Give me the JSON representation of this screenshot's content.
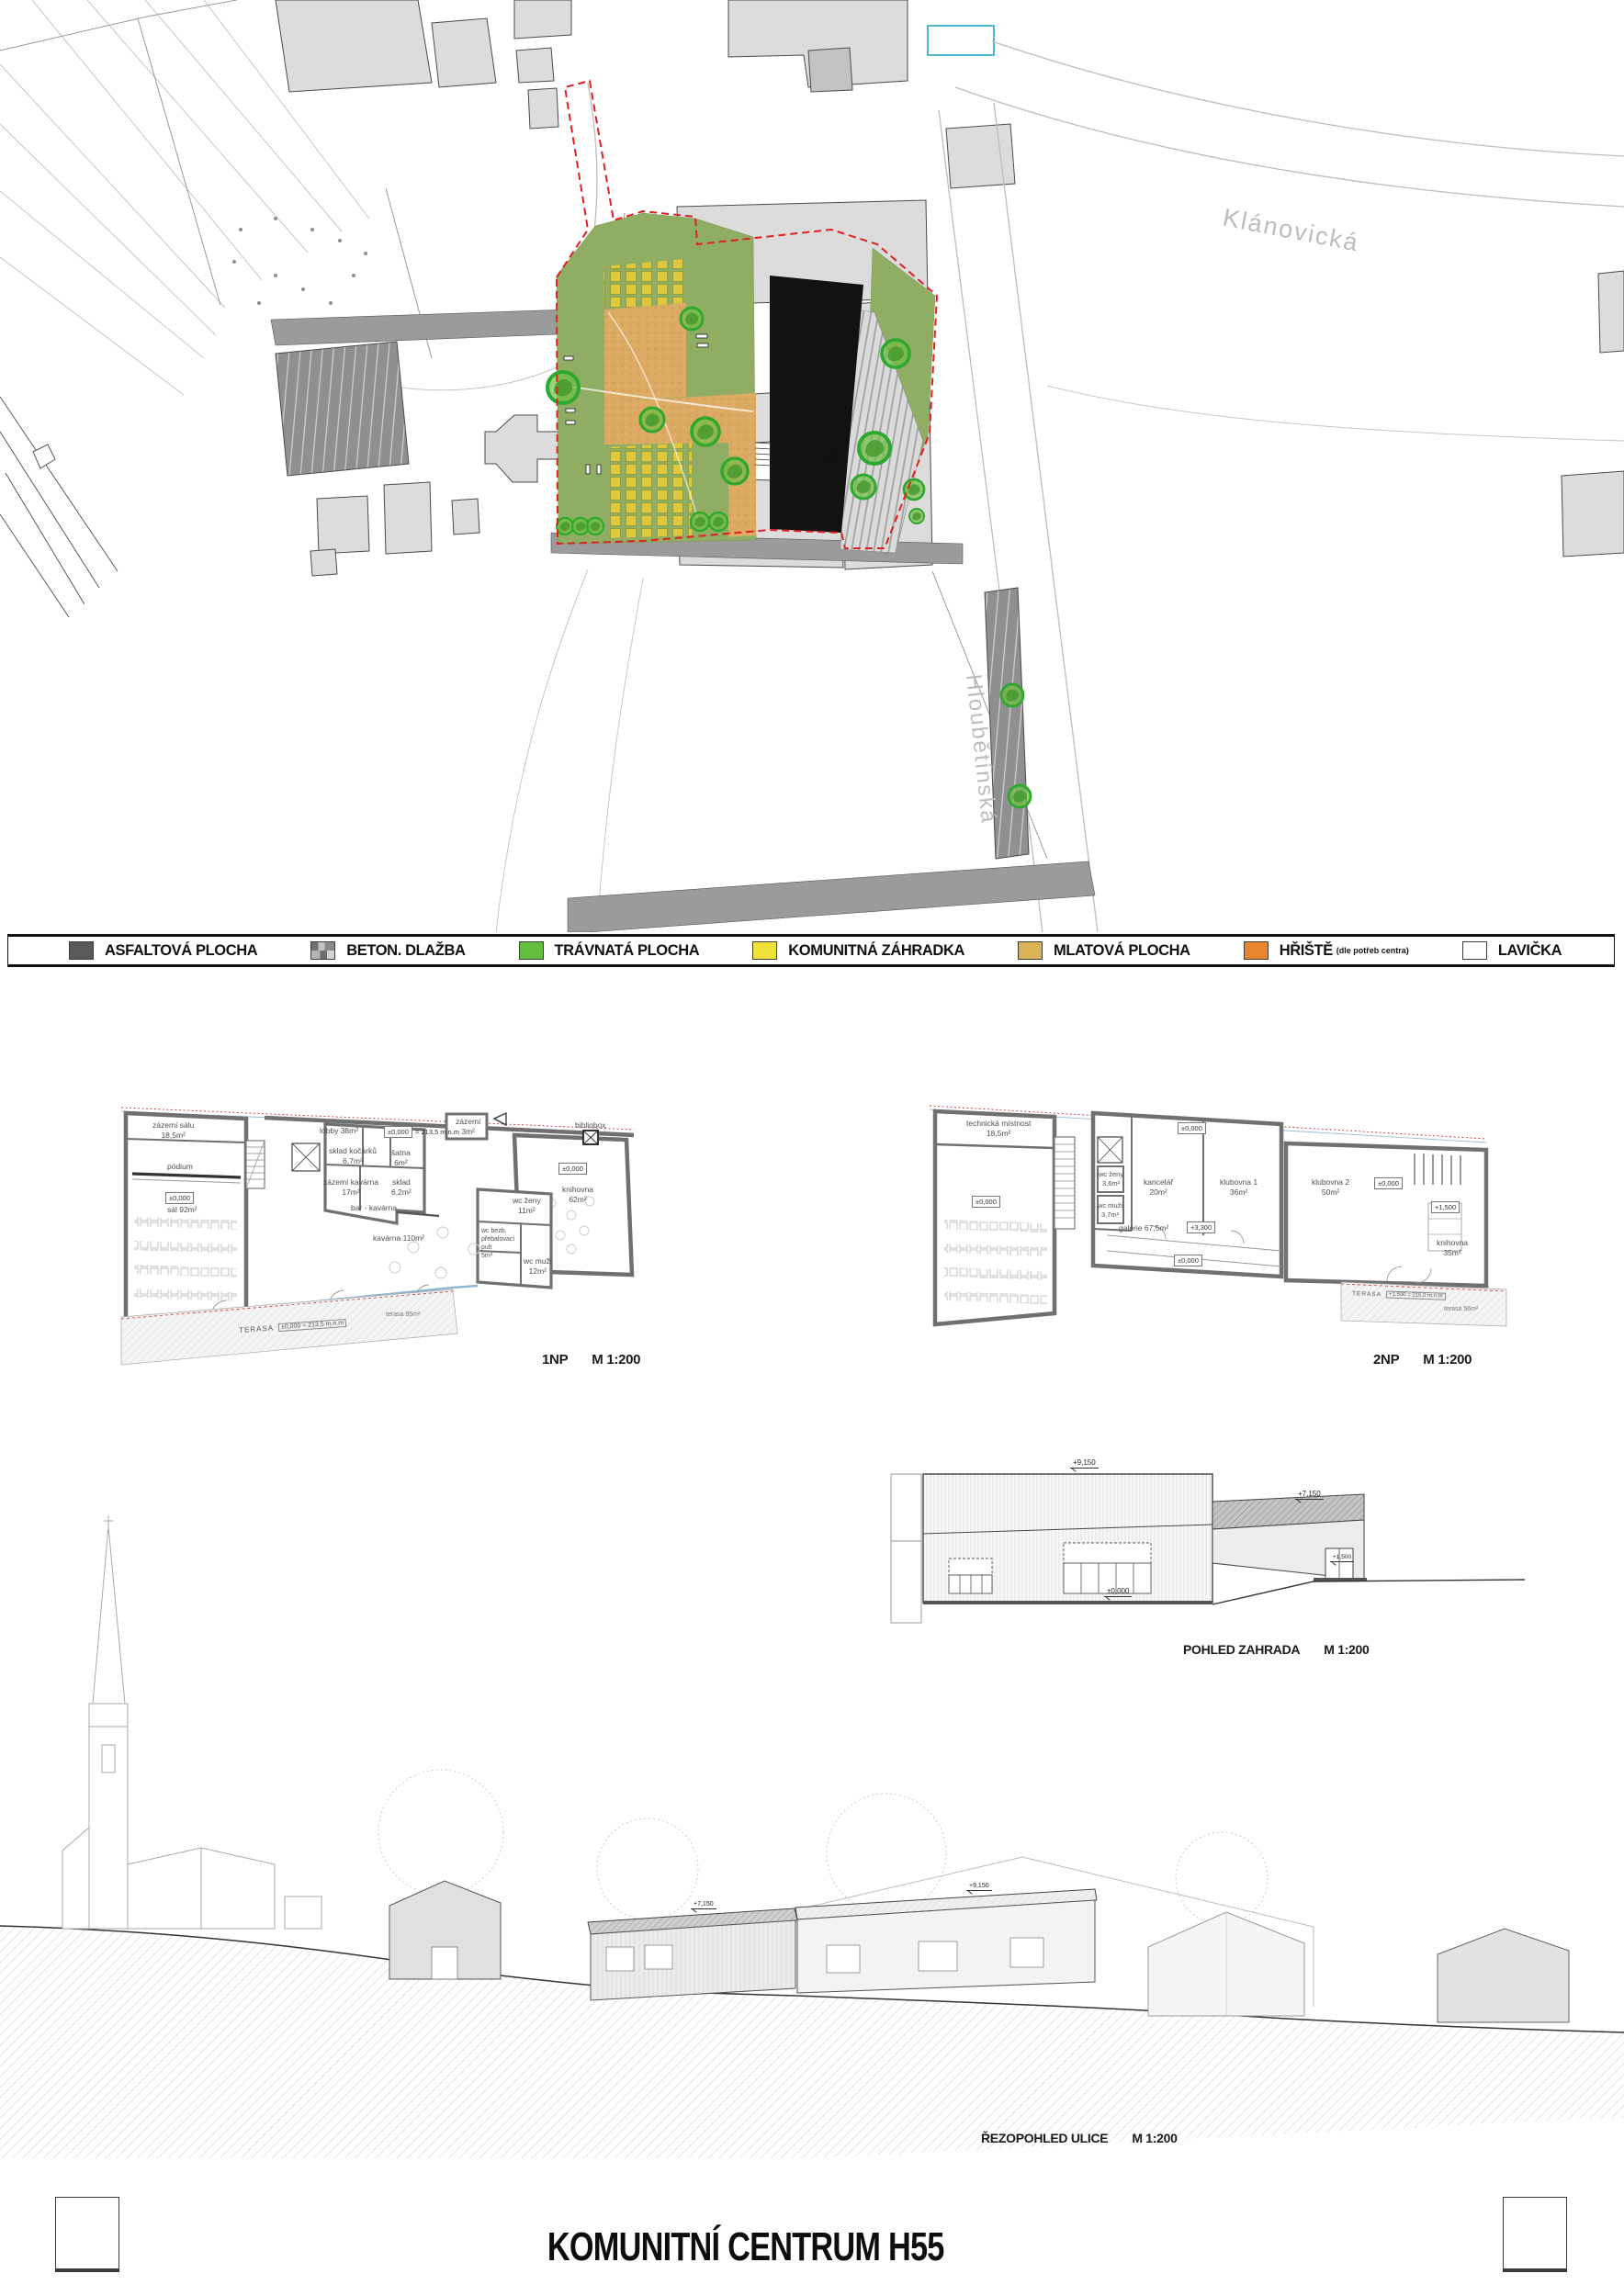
{
  "sheet": {
    "title": "KOMUNITNÍ CENTRUM H55"
  },
  "site_plan": {
    "streets": {
      "klanovicka": "Klánovická",
      "hloubetinska": "Hloubětínská"
    },
    "colors": {
      "asphalt": "#595959",
      "concrete_paving": "#9a9a9a",
      "grass": "#8fae63",
      "community_garden": "#ddc83e",
      "mlat": "#dcaa63",
      "playground": "#e8862d",
      "tree": "#4db838",
      "black_roof_building": "#111111",
      "site_boundary_red": "#e02020",
      "context_building": "#dcdcdc",
      "pool_outline": "#49b8cc"
    }
  },
  "legend": {
    "items": [
      {
        "label": "ASFALTOVÁ PLOCHA",
        "color": "#595959"
      },
      {
        "label": "BETON. DLAŽBA",
        "color": "#9a9a9a"
      },
      {
        "label": "TRÁVNATÁ PLOCHA",
        "color": "#65bf3f"
      },
      {
        "label": "KOMUNITNÁ ZÁHRADKA",
        "color": "#f0e23a"
      },
      {
        "label": "MLATOVÁ PLOCHA",
        "color": "#d9b356"
      },
      {
        "label": "HŘIŠTĚ",
        "sublabel": "(dle potřeb centra)",
        "color": "#e8862d"
      },
      {
        "label": "LAVIČKA",
        "color": "#ffffff"
      }
    ],
    "drawing_name": "SITUACE",
    "scale": "M 1:500"
  },
  "plan_1np": {
    "caption": "1NP",
    "scale": "M 1:200",
    "rooms": {
      "zazemi_salu": "zázemí sálu\n18,5m²",
      "podium": "pódium",
      "level_sal": "±0,000",
      "sal": "sál  92m²",
      "lobby": "lobby  38m²",
      "level_lobby": "±0,000",
      "level_lobby_suffix": "= 213,5 m.n.m",
      "sklad_kocarku": "sklad kočárků\n6,7m²",
      "satna": "šatna\n6m²",
      "zazemi_kavarna": "zázemí kavárna\n17m²",
      "sklad": "sklad\n6,2m²",
      "bar": "bar - kavárna",
      "kavarna": "kavárna  110m²",
      "zazemi": "zázemí\n3m²",
      "bibliobox": "bibliobox",
      "level_knihovna": "±0,000",
      "knihovna": "knihovna\n62m²",
      "wc_zeny": "wc ženy\n11m²",
      "wc_bezb": "wc bezb.\npřebalovací\npult\n5m²",
      "wc_muzi": "wc muži\n12m²",
      "terasa_label": "TERASA",
      "terasa_level": "±0,000 = 213,5 m.n.m",
      "terasa_area": "terasa  95m²"
    }
  },
  "plan_2np": {
    "caption": "2NP",
    "scale": "M 1:200",
    "rooms": {
      "technicka": "technická místnost\n18,5m²",
      "level_hall": "±0,000",
      "level_wing": "±0,000",
      "wc_zeny": "wc ženy\n3,6m²",
      "wc_muzi": "wc muži\n3,7m²",
      "kancelar": "kancelář\n20m²",
      "galerie": "galerie  67,5m²",
      "level_galerie": "+3,300",
      "level_void": "±0,000",
      "klubovna1": "klubovna 1\n36m²",
      "klubovna2": "klubovna 2\n50m²",
      "level_klubovna2": "±0,000",
      "level_terasa": "+1,500",
      "knihovna": "knihovna\n35m²",
      "terasa_label": "TERASA",
      "terasa_level": "+1,500 = 215,0 m.n.m",
      "terasa_area": "terasa  56m²"
    }
  },
  "pohled_zahrada": {
    "caption": "POHLED ZAHRADA",
    "scale": "M 1:200",
    "marks": {
      "roof_main": "+9,150",
      "roof_low": "+7,150",
      "ground": "±0,000",
      "door": "+1,500"
    }
  },
  "rez_ulice": {
    "caption": "ŘEZOPOHLED ULICE",
    "scale": "M 1:200",
    "marks": {
      "roof_low": "+7,150",
      "roof_main": "+9,150"
    }
  }
}
